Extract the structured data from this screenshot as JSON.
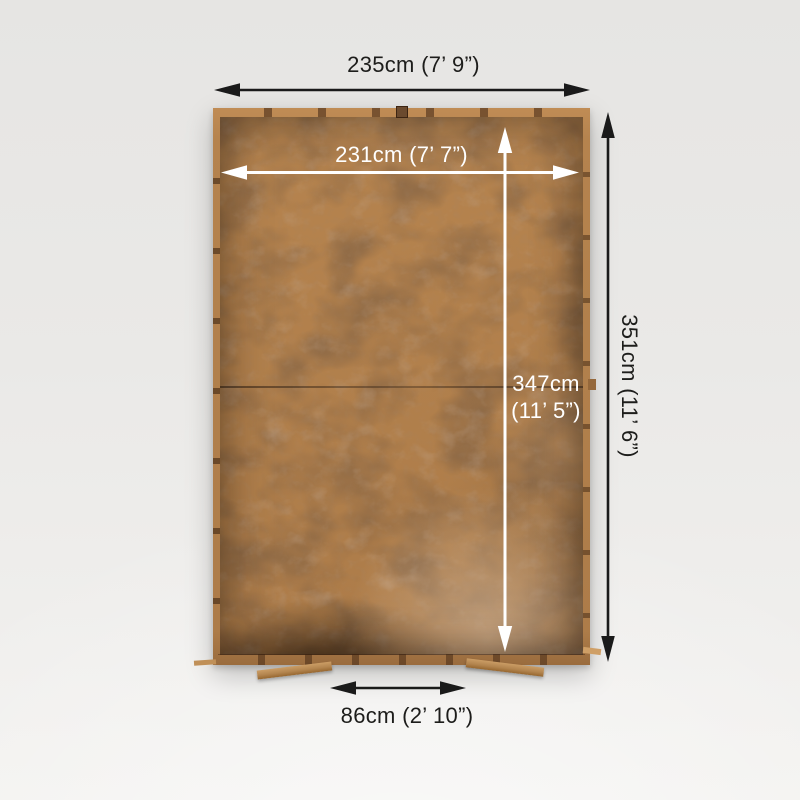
{
  "diagram": {
    "dimensions": {
      "outer_width": "235cm (7’ 9”)",
      "inner_width": "231cm (7’ 7”)",
      "outer_depth": "351cm (11’ 6”)",
      "inner_depth_line1": "347cm",
      "inner_depth_line2": "(11’ 5”)",
      "door_width": "86cm (2’ 10”)"
    },
    "icons": [
      "double-arrow-horizontal-icon",
      "double-arrow-vertical-icon"
    ],
    "colors": {
      "background": "#eae9e7",
      "roof_felt_brown": "#4a362a",
      "frame_wood_tan": "#b5834e",
      "dimension_dark": "#1d1d1b",
      "dimension_light": "#ffffff"
    }
  }
}
